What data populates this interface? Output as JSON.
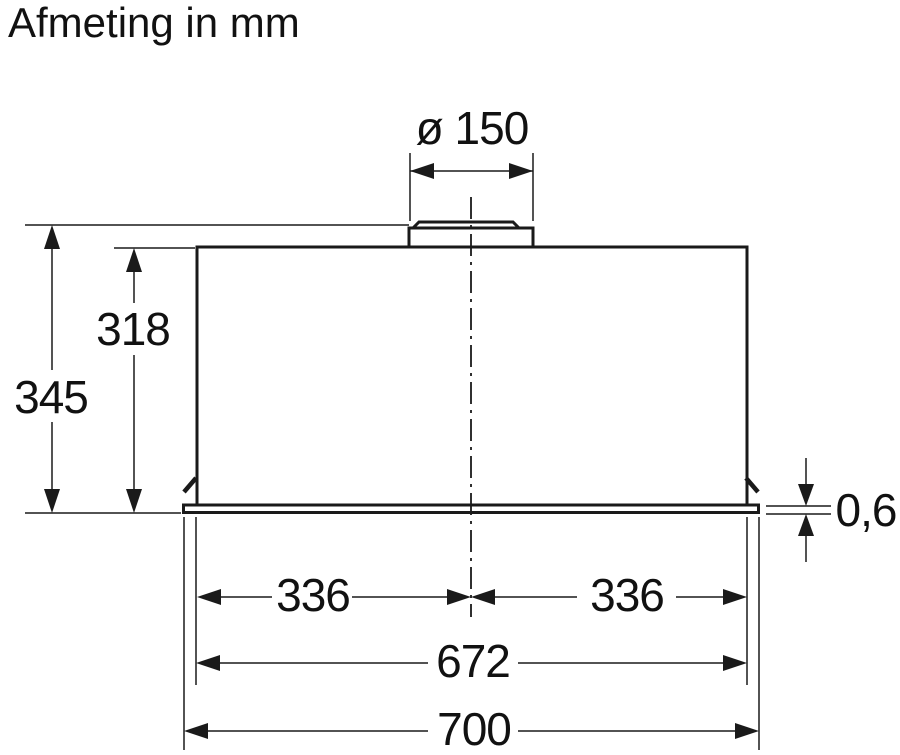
{
  "title": "Afmeting in mm",
  "drawing": {
    "kind": "technical-dimension-drawing",
    "subject": "built-in cooker hood, front elevation with duct collar",
    "unit": "mm",
    "colors": {
      "line": "#1a1a1a",
      "background": "#ffffff"
    },
    "dims": {
      "duct_diameter": {
        "label": "ø 150",
        "value": 150,
        "orientation": "horizontal"
      },
      "total_height": {
        "label": "345",
        "value": 345,
        "orientation": "vertical"
      },
      "body_height": {
        "label": "318",
        "value": 318,
        "orientation": "vertical"
      },
      "panel_thickness": {
        "label": "0,6",
        "value": 0.6,
        "orientation": "vertical"
      },
      "half_width_left": {
        "label": "336",
        "value": 336,
        "orientation": "horizontal"
      },
      "half_width_right": {
        "label": "336",
        "value": 336,
        "orientation": "horizontal"
      },
      "body_width": {
        "label": "672",
        "value": 672,
        "orientation": "horizontal"
      },
      "panel_width": {
        "label": "700",
        "value": 700,
        "orientation": "horizontal"
      }
    }
  }
}
